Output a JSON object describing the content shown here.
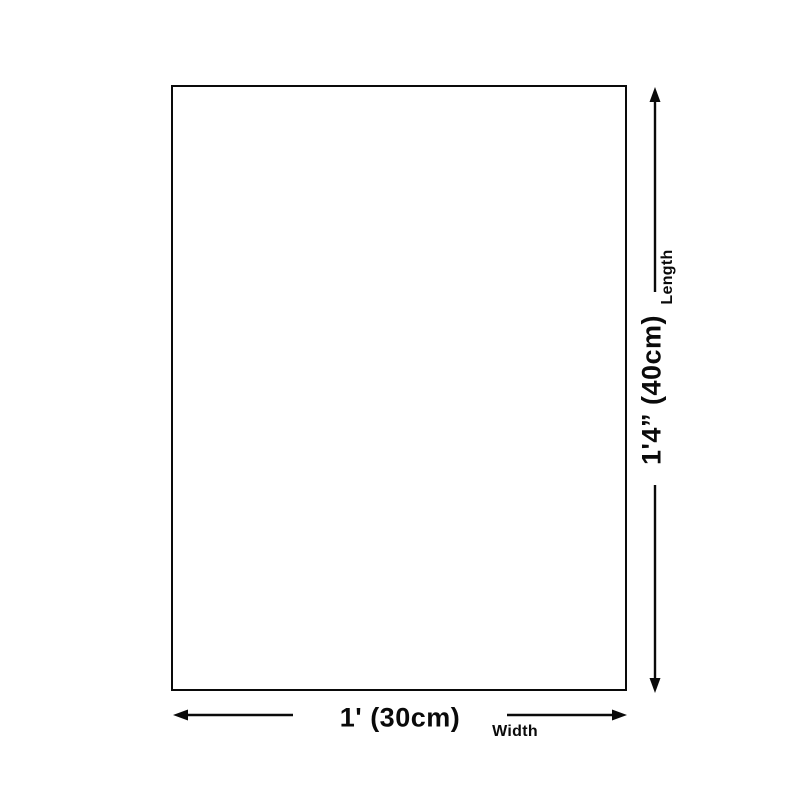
{
  "diagram": {
    "title": "product-size-diagram",
    "length": {
      "value": "1'4” (40cm)",
      "label": "Length"
    },
    "width": {
      "value": "1' (30cm)",
      "label": "Width"
    },
    "colors": {
      "line": "#0a0a0a",
      "text": "#0a0a0a",
      "background": "#ffffff"
    }
  }
}
